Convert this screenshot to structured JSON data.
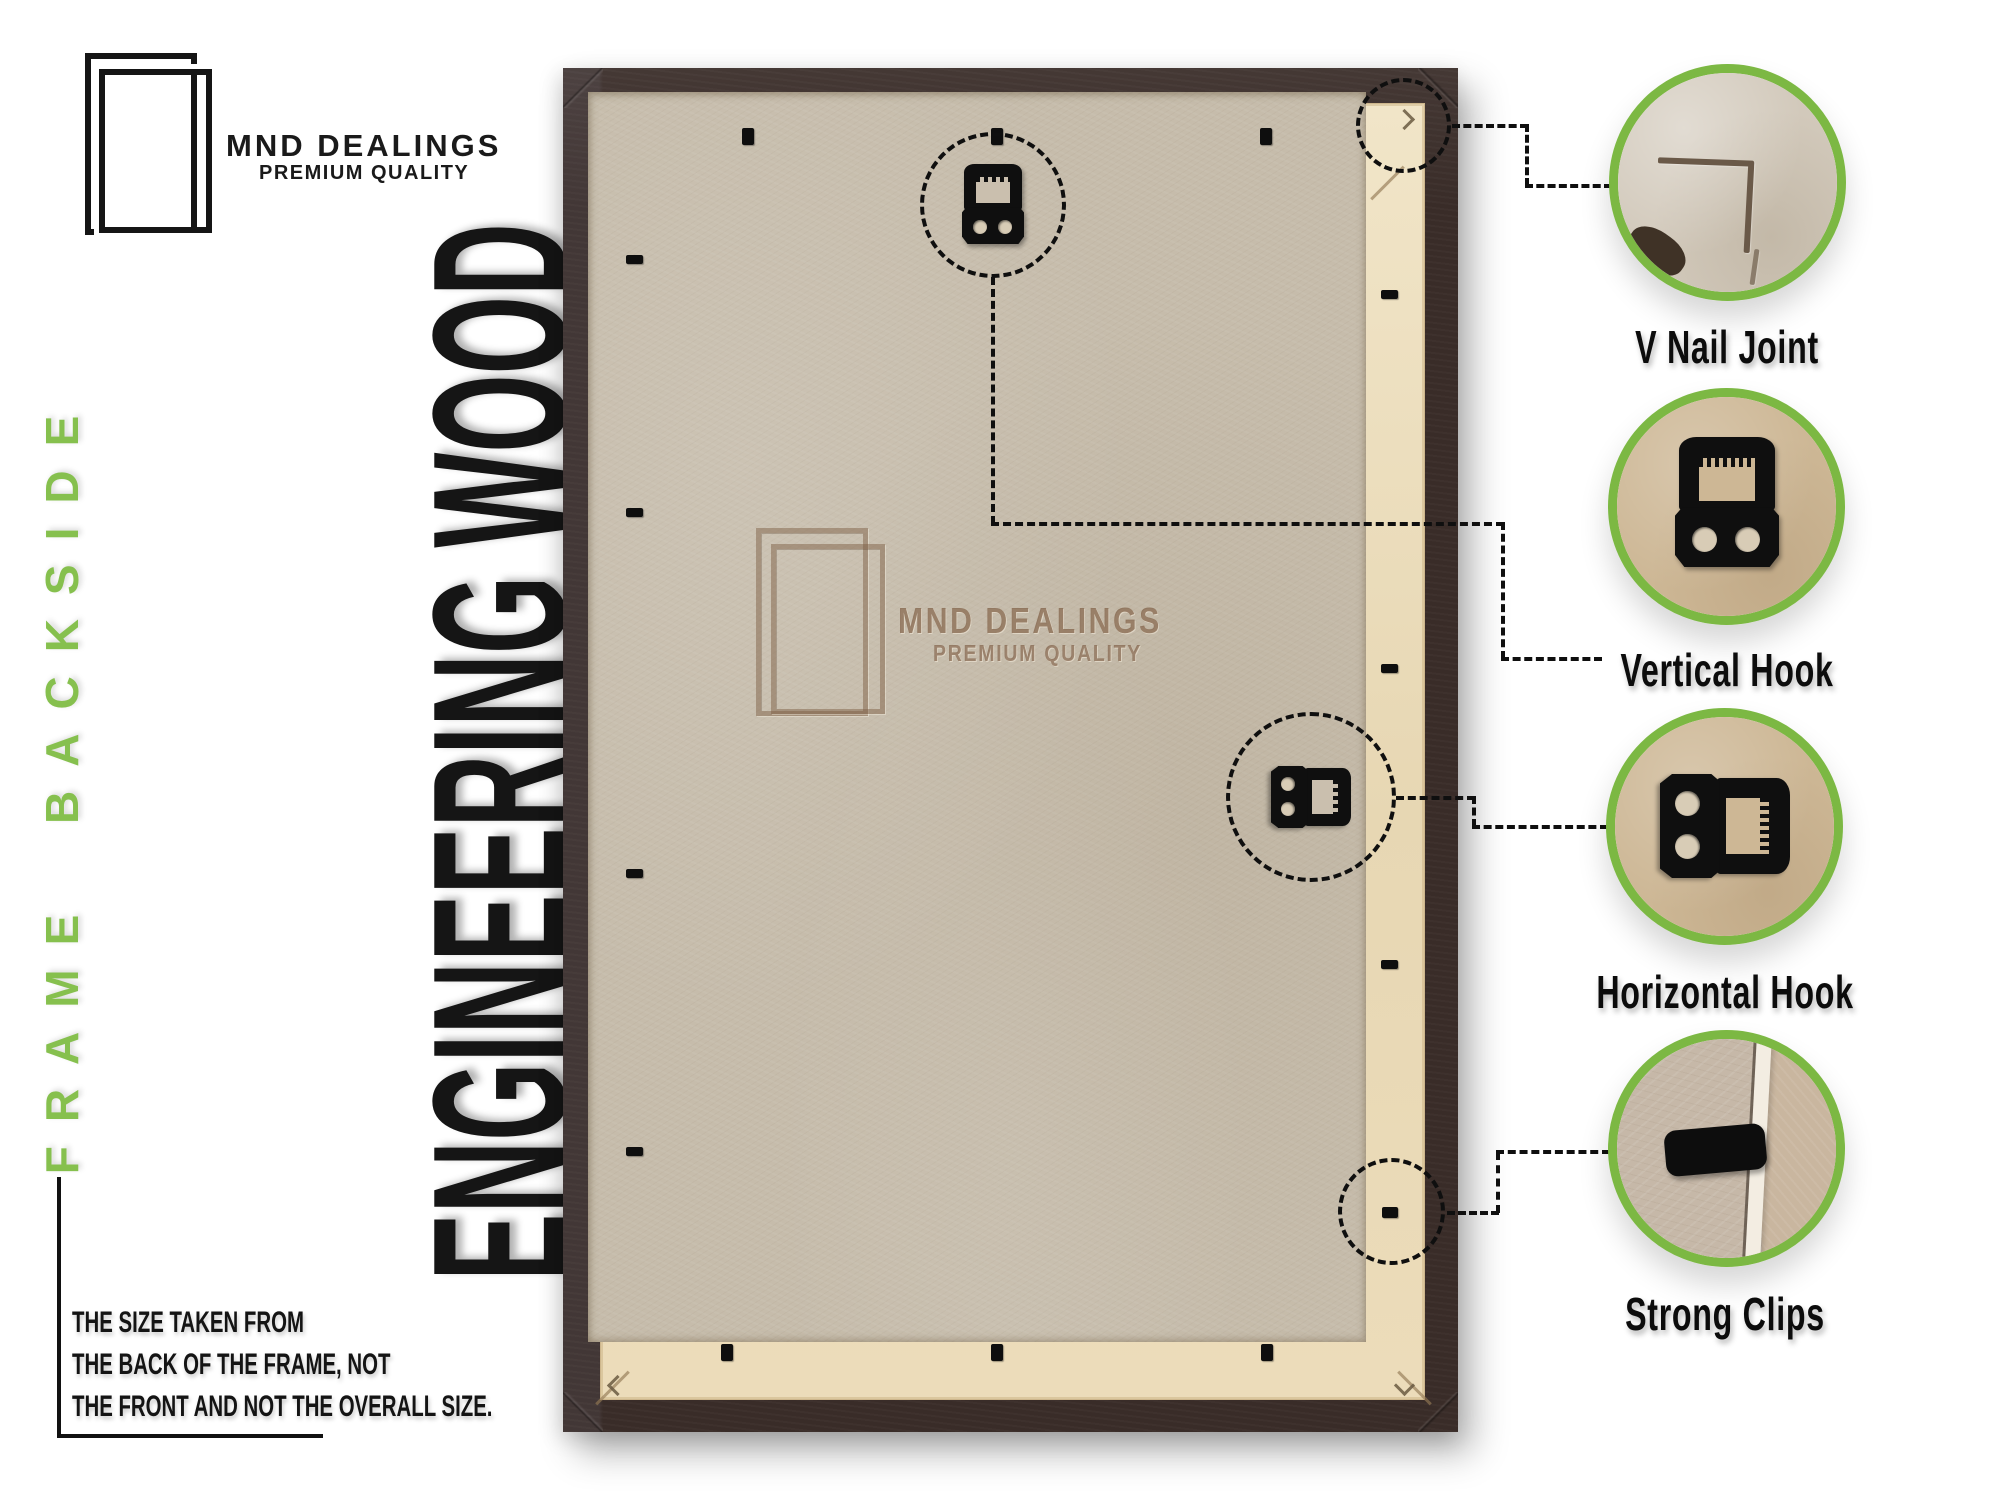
{
  "brand": {
    "name": "MND DEALINGS",
    "tagline": "PREMIUM QUALITY"
  },
  "side_label": "FRAME BACKSIDE",
  "material_label": "ENGINEERING WOOD",
  "note": {
    "lines": [
      "THE SIZE TAKEN FROM",
      "THE BACK OF THE FRAME, NOT",
      "THE FRONT AND NOT THE OVERALL SIZE."
    ]
  },
  "watermark": {
    "name": "MND DEALINGS",
    "tagline": "PREMIUM QUALITY"
  },
  "callouts": [
    {
      "id": "v-nail-joint",
      "label": "V Nail Joint"
    },
    {
      "id": "vertical-hook",
      "label": "Vertical Hook"
    },
    {
      "id": "horizontal-hook",
      "label": "Horizontal Hook"
    },
    {
      "id": "strong-clips",
      "label": "Strong Clips"
    }
  ],
  "colors": {
    "accent_green": "#7cb843",
    "side_label_green": "#86c04e",
    "frame_brown": "#392c28",
    "lip_cream": "#ecdfc1",
    "board_tan": "#c6bcab",
    "ink": "#101010"
  }
}
